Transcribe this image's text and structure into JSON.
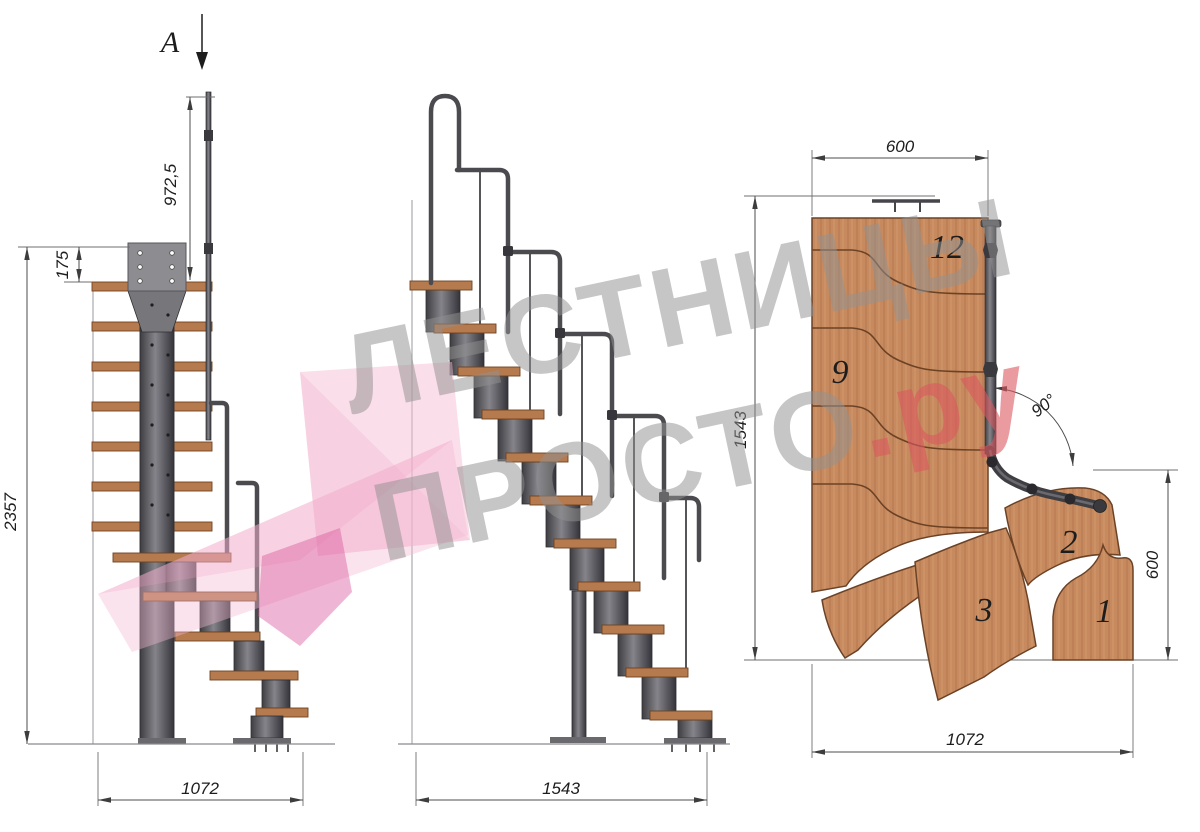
{
  "watermark": {
    "line1": "ЛЕСТНИЦЫ",
    "line2_main": "ПРОСТО",
    "line2_suffix": ".ру"
  },
  "section_marker": {
    "label": "A"
  },
  "side_view": {
    "dim_handrail_height": "972,5",
    "dim_top_plate_height": "175",
    "dim_total_height": "2357",
    "dim_width": "1072"
  },
  "front_view": {
    "dim_length": "1543"
  },
  "plan_view": {
    "dim_top_width": "600",
    "dim_left_length": "1543",
    "dim_right_depth": "600",
    "dim_bottom_width": "1072",
    "dim_turn_angle": "90°",
    "step_labels": {
      "s12": "12",
      "s9": "9",
      "s3": "3",
      "s2": "2",
      "s1": "1"
    }
  },
  "colors": {
    "wood": "#c78a5e",
    "metal": "#47474b",
    "dimension_line": "#4d4d4d",
    "watermark_gray": "#929292",
    "watermark_red": "#db5860",
    "logo_pink": "#f4bad1"
  }
}
